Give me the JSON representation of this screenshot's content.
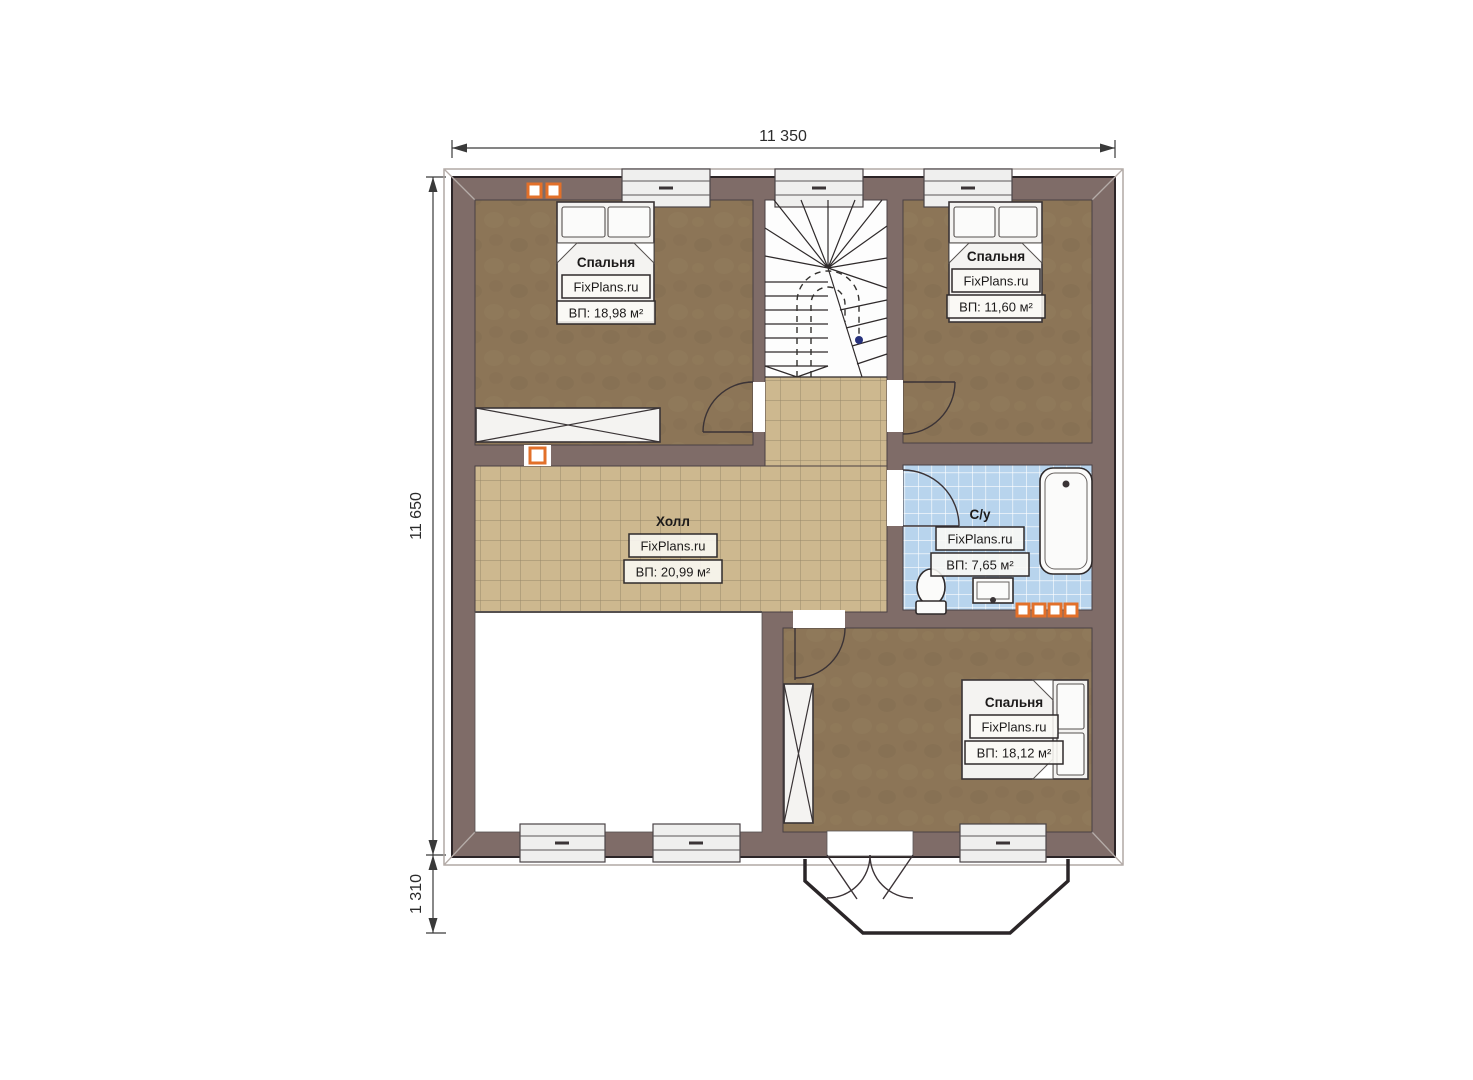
{
  "dims": {
    "top": "11 350",
    "left": "11 650",
    "balcony": "1 310"
  },
  "rooms": {
    "bedroom_top_left": {
      "name": "Спальня",
      "brand": "FixPlans.ru",
      "area": "ВП: 18,98 м²"
    },
    "bedroom_top_right": {
      "name": "Спальня",
      "brand": "FixPlans.ru",
      "area": "ВП: 11,60 м²"
    },
    "hall": {
      "name": "Холл",
      "brand": "FixPlans.ru",
      "area": "ВП: 20,99 м²"
    },
    "bathroom": {
      "name": "С/у",
      "brand": "FixPlans.ru",
      "area": "ВП: 7,65 м²"
    },
    "bedroom_bottom": {
      "name": "Спальня",
      "brand": "FixPlans.ru",
      "area": "ВП: 18,12 м²"
    }
  },
  "colors": {
    "wall": "#7f6c68",
    "bedroom_floor": "#8c7557",
    "floor_spot_dark": "#7e694d",
    "floor_spot_light": "#97825f",
    "hall_tile": "#cdb88f",
    "hall_grout": "#97876a",
    "bath_tile": "#b8d4ed",
    "vent": "#e2702a",
    "outline": "#2c2527"
  }
}
